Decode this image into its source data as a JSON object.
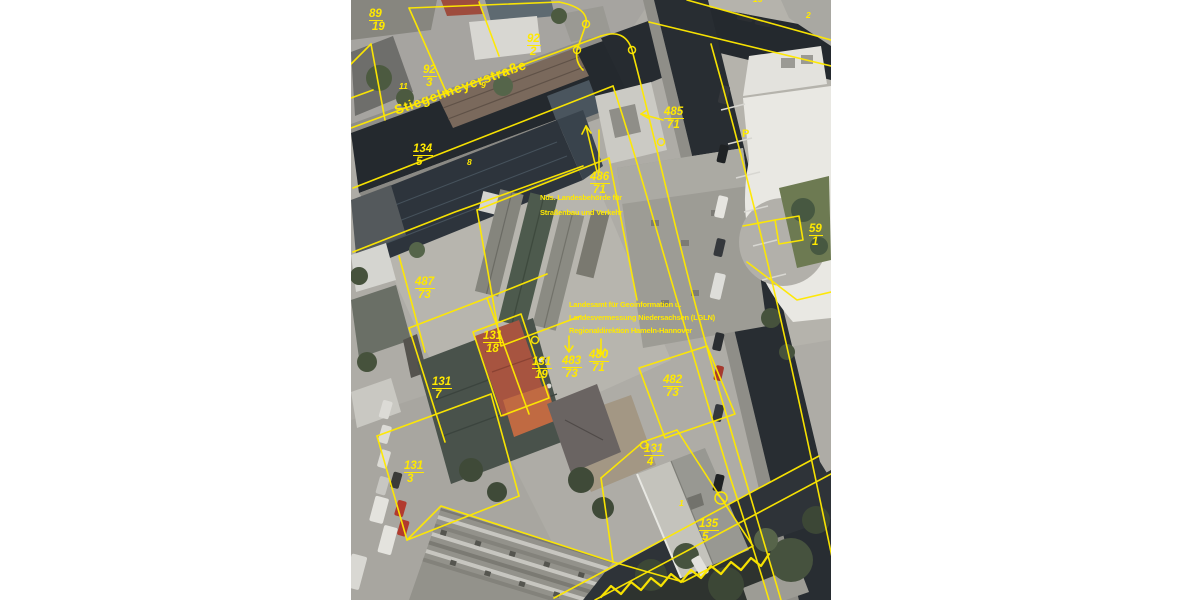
{
  "map": {
    "street_label": "Stiegelmeyerstraße",
    "parking_label": "P",
    "colors": {
      "overlay_yellow": "#ffe900",
      "page_bg": "#ffffff",
      "road_dark": "#24292e",
      "pavement": "#aeaca6"
    },
    "street_label_pos": {
      "x": 44,
      "y": 104,
      "rotation": -19.5
    },
    "parking_label_pos": {
      "x": 391,
      "y": 129
    },
    "text_blocks": [
      {
        "id": "agency-roads",
        "x": 189,
        "y": 190,
        "line_height": 15,
        "lines": [
          "Nds. Landesbehörde für",
          "Straßenbau und Verkehr"
        ]
      },
      {
        "id": "agency-lgln",
        "x": 218,
        "y": 298,
        "line_height": 13,
        "lines": [
          "Landesamt für Geoinformation u.",
          "Landesvermessung Niedersachsen (LGLN)",
          "Regionaldirektion Hameln-Hannover"
        ]
      }
    ],
    "parcel_labels": [
      {
        "num": "89",
        "den": "19",
        "x": 18,
        "y": 8
      },
      {
        "num": "92",
        "den": "2",
        "x": 176,
        "y": 33
      },
      {
        "num": "92",
        "den": "3",
        "x": 72,
        "y": 64
      },
      {
        "num": "134",
        "den": "5",
        "x": 62,
        "y": 143
      },
      {
        "num": "485",
        "den": "71",
        "x": 313,
        "y": 106
      },
      {
        "num": "486",
        "den": "71",
        "x": 239,
        "y": 171
      },
      {
        "num": "487",
        "den": "73",
        "x": 64,
        "y": 276
      },
      {
        "num": "59",
        "den": "1",
        "x": 458,
        "y": 223
      },
      {
        "num": "131",
        "den": "18",
        "x": 132,
        "y": 330
      },
      {
        "num": "131",
        "den": "19",
        "x": 181,
        "y": 356
      },
      {
        "num": "483",
        "den": "73",
        "x": 211,
        "y": 355
      },
      {
        "num": "480",
        "den": "71",
        "x": 238,
        "y": 349
      },
      {
        "num": "482",
        "den": "73",
        "x": 312,
        "y": 374
      },
      {
        "num": "131",
        "den": "7",
        "x": 81,
        "y": 376
      },
      {
        "num": "131",
        "den": "3",
        "x": 53,
        "y": 460
      },
      {
        "num": "131",
        "den": "4",
        "x": 293,
        "y": 443
      },
      {
        "num": "135",
        "den": "5",
        "x": 348,
        "y": 518
      }
    ],
    "small_labels": [
      {
        "text": "9",
        "x": 130,
        "y": 81
      },
      {
        "text": "11",
        "x": 48,
        "y": 82
      },
      {
        "text": "8",
        "x": 116,
        "y": 158
      },
      {
        "text": "1",
        "x": 328,
        "y": 499
      },
      {
        "text": "2",
        "x": 455,
        "y": 11
      },
      {
        "text": "15",
        "x": 402,
        "y": -5
      }
    ]
  }
}
